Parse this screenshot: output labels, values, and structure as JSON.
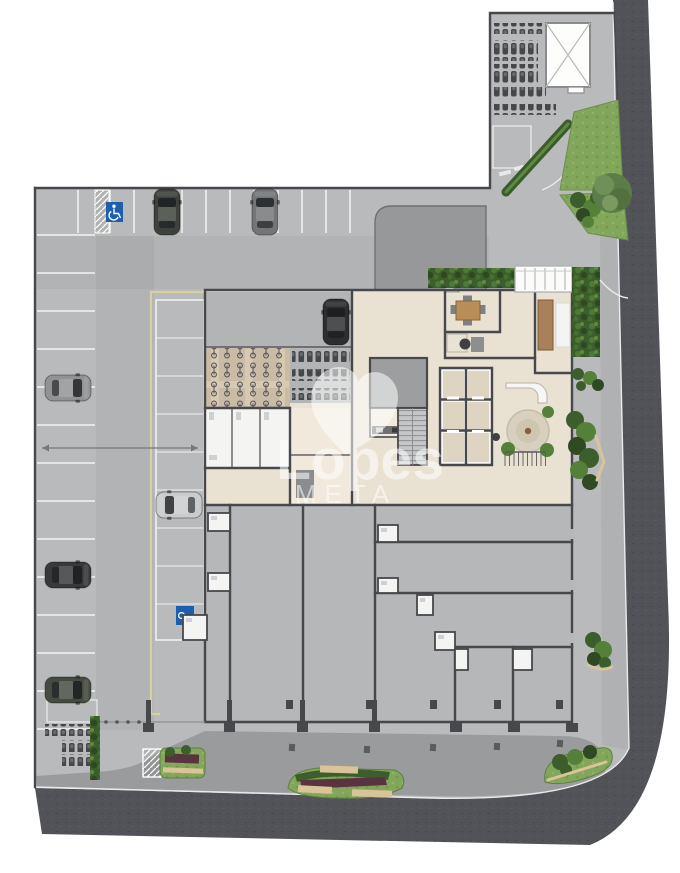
{
  "watermark": {
    "brand": "Lopes",
    "division": "META",
    "heart_icon": "heart-icon"
  },
  "signs": {
    "accessible_parking": {
      "icon": "wheelchair-icon",
      "color": "#1d5fae"
    },
    "reserved_parking": {
      "icon": "key-icon",
      "color": "#1d5fae"
    }
  },
  "colors": {
    "page_bg": "#ffffff",
    "plate": "#b9babb",
    "stall": "#b3b4b5",
    "road": "#525358",
    "sidewalk": "#b0b1b2",
    "sidewalk_dark": "#9a9b9c",
    "ramp": "#97989a",
    "wall": "#47484b",
    "marking": "#f2f3f4",
    "lane": "#d9cfa2",
    "curb": "#e9eaeb",
    "curb_tan": "#d9c49a",
    "floor": "#e9e2d3",
    "floor_warm": "#f0e9dc",
    "retail": "#b6b7b8",
    "bath": "#f4f4f2",
    "elevator": "#ddd5c2",
    "service": "#9d9e9f",
    "bike_floor": "#c9bba6",
    "hedge": "#3c5e2d",
    "hedge_light": "#54803a",
    "grass": "#82a75b",
    "tree": "#5c7d49",
    "planter_red": "#5a3340",
    "sign_blue": "#1d5fae",
    "watermark": "#ffffff"
  },
  "objects": {
    "cars": [
      {
        "name": "car-dark-green",
        "x": 167,
        "y": 212,
        "deg": 0,
        "color": "#3d423c"
      },
      {
        "name": "car-gray",
        "x": 265,
        "y": 212,
        "deg": 0,
        "color": "#737576"
      },
      {
        "name": "car-black",
        "x": 336,
        "y": 322,
        "deg": 0,
        "color": "#2c2e30"
      },
      {
        "name": "car-light-gray",
        "x": 68,
        "y": 388,
        "deg": 90,
        "color": "#909293"
      },
      {
        "name": "car-silver",
        "x": 179,
        "y": 505,
        "deg": 270,
        "color": "#c9cbcc"
      },
      {
        "name": "car-dark",
        "x": 68,
        "y": 575,
        "deg": 90,
        "color": "#37393b"
      },
      {
        "name": "car-green",
        "x": 68,
        "y": 690,
        "deg": 90,
        "color": "#454b41"
      }
    ]
  }
}
